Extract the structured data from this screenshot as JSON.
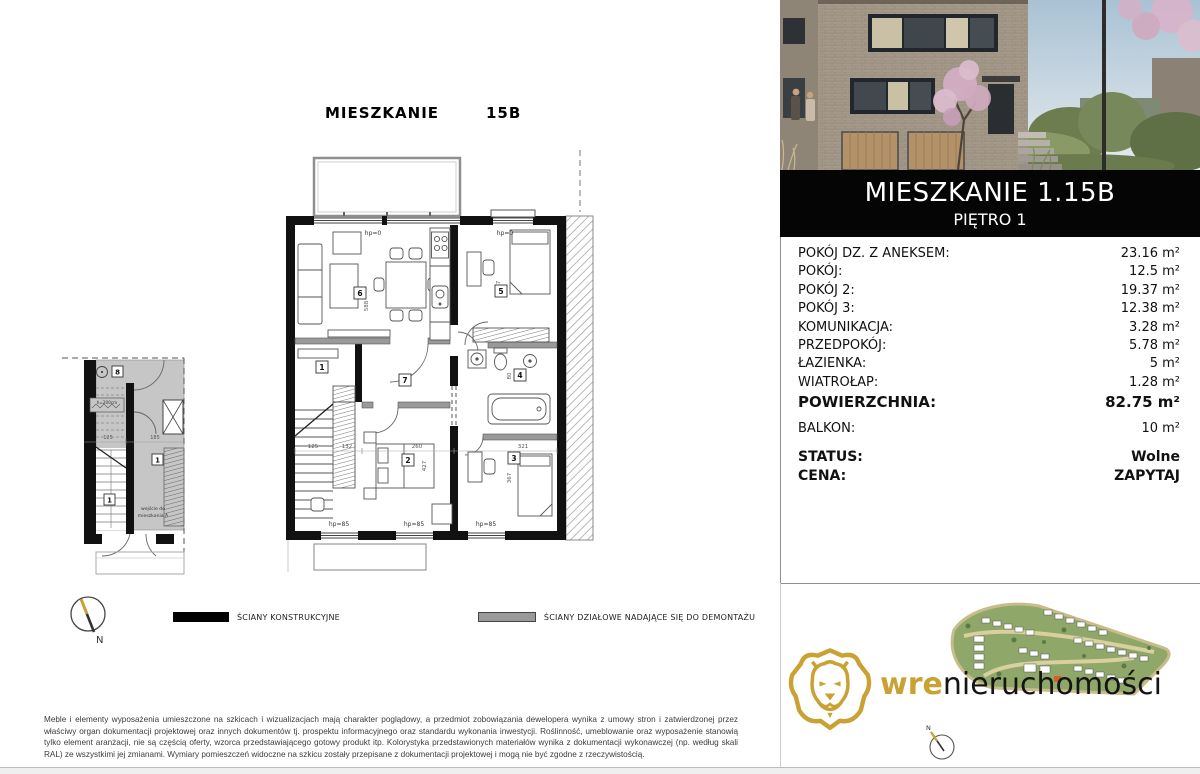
{
  "page_title": {
    "left": "MIESZKANIE",
    "unit": "15B"
  },
  "panel": {
    "header_title": "MIESZKANIE 1.15B",
    "header_subtitle": "PIĘTRO 1",
    "rows": [
      {
        "label": "POKÓJ DZ. Z ANEKSEM:",
        "value": "23.16 m²"
      },
      {
        "label": "POKÓJ:",
        "value": "12.5 m²"
      },
      {
        "label": "POKÓJ 2:",
        "value": "19.37 m²"
      },
      {
        "label": "POKÓJ 3:",
        "value": "12.38 m²"
      },
      {
        "label": "KOMUNIKACJA:",
        "value": "3.28 m²"
      },
      {
        "label": "PRZEDPOKÓJ:",
        "value": "5.78 m²"
      },
      {
        "label": "ŁAZIENKA:",
        "value": "5 m²"
      },
      {
        "label": "WIATROŁAP:",
        "value": "1.28 m²"
      }
    ],
    "total": {
      "label": "POWIERZCHNIA:",
      "value": "82.75 m²"
    },
    "balcony": {
      "label": "BALKON:",
      "value": "10 m²"
    },
    "status": {
      "label": "STATUS:",
      "value": "Wolne"
    },
    "price": {
      "label": "CENA:",
      "value": "ZAPYTAJ"
    }
  },
  "legend": {
    "structural": "ŚCIANY KONSTRUKCYJNE",
    "partition": "ŚCIANY DZIAŁOWE NADAJĄCE SIĘ DO DEMONTAŻU"
  },
  "disclaimer": "Meble i elementy wyposażenia umieszczone na szkicach i wizualizacjach mają charakter poglądowy, a przedmiot zobowiązania dewelopera wynika z umowy stron i zatwierdzonej przez właściwy organ dokumentacji projektowej oraz innych dokumentów tj. prospektu informacyjnego oraz standardu wykonania inwestycji. Roślinność, umeblowanie oraz wyposażenie stanowią tylko element aranżacji, nie są częścią oferty, wzorca przedstawiającego gotowy produkt itp. Kolorystyka przedstawionych materiałów wynika z dokumentacji wykonawczej (np. według skali RAL) ze wszystkimi jej zmianami. Wymiary pomieszczeń widoczne na szkicu zostały przepisane z dokumentacji projektowej i mogą nie być zgodne z rzeczywistością.",
  "logo": {
    "brand_gold": "wre",
    "brand_black": "nieruchomości"
  },
  "plan": {
    "rooms": {
      "r1": "1",
      "r2": "2",
      "r3": "3",
      "r4": "4",
      "r5": "5",
      "r6": "6",
      "r7": "7",
      "r8": "8"
    },
    "labels": {
      "hp0": "hp=0",
      "hp85": "hp=85",
      "north": "N",
      "entrance_line1": "wejście do",
      "entrance_line2": "mieszkania A",
      "headroom": "h=200cm"
    },
    "dims": {
      "d125": "125",
      "d132": "132",
      "d260": "260",
      "d321": "321",
      "d427": "427",
      "d367": "367",
      "d80": "80",
      "d588": "588",
      "d357": "357",
      "d185": "185"
    }
  },
  "colors": {
    "gold": "#C9A233",
    "wall_black": "#111111",
    "partition_gray": "#9a9a9a",
    "site_green": "#8fa768"
  }
}
